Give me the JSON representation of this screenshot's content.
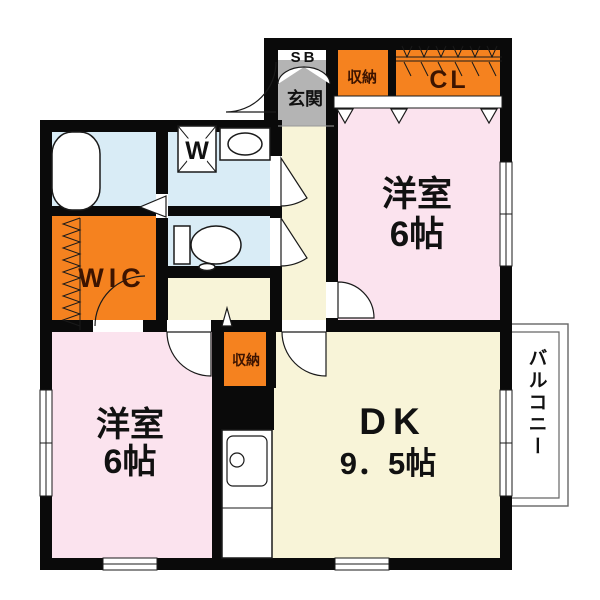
{
  "floorplan": {
    "labels": {
      "shoe_box": "SB",
      "entrance": "玄関",
      "storage_top": "収納",
      "closet": "CL",
      "western_room_1": "洋室",
      "western_room_1_size": "6帖",
      "washer": "W",
      "wic": "WIC",
      "storage_center": "収納",
      "western_room_2": "洋室",
      "western_room_2_size": "6帖",
      "dining_kitchen": "DK",
      "dining_kitchen_size": "9．5帖",
      "balcony": "バルコニー"
    },
    "colors": {
      "wall": "#0a0a0a",
      "room_pink": "#fbe3ee",
      "room_cream": "#f8f4d8",
      "room_blue": "#d9ecf6",
      "accent_orange": "#f5821f",
      "entrance_gray": "#b4b4b4",
      "label_on_orange": "#3d1400",
      "text": "#111111"
    }
  }
}
